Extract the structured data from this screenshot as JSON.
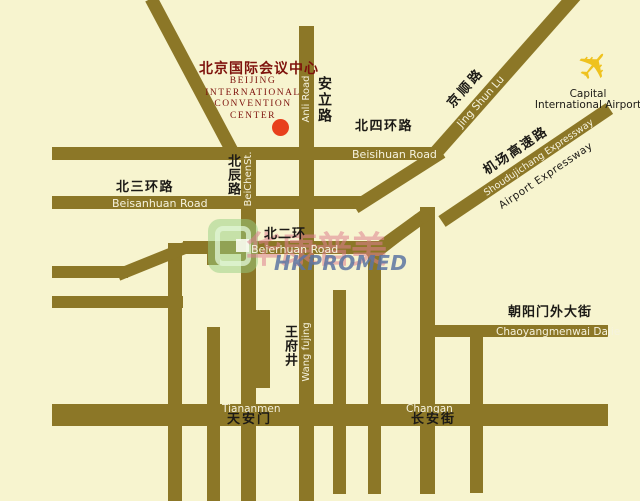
{
  "map": {
    "background_color": "#F7F4CF",
    "road_color": "#8C7727",
    "title": {
      "cn": "北京国际会议中心",
      "en_lines": [
        "BEIJING",
        "INTERNATIONAL",
        "CONVENTION",
        "CENTER"
      ],
      "color": "#7E120C"
    },
    "marker": {
      "color": "#E8401C"
    },
    "airport": {
      "line1": "Capital",
      "line2": "International Airport",
      "plane_color": "#EFC21F",
      "plane_glyph": "✈"
    },
    "roads": {
      "beisihuan": {
        "cn": "北四环路",
        "en": "Beisihuan Road"
      },
      "beisanhuan": {
        "cn": "北三环路",
        "en": "Beisanhuan Road"
      },
      "beierhuan": {
        "cn": "北二环",
        "en": "Beierhuan Road"
      },
      "beichen": {
        "cn": "北辰路",
        "en": "BeiChenSt."
      },
      "anli": {
        "cn": "安立路",
        "en": "Anli Road"
      },
      "jingshun": {
        "cn": "京顺路",
        "en": "Jing Shun Lu"
      },
      "airport_expressway": {
        "cn": "机场高速路",
        "en_on_road": "Shoudujichang Expressway",
        "en_below": "Airport Expressway"
      },
      "chaoyangmenwai": {
        "cn": "朝阳门外大街",
        "en": "Chaoyangmenwai Dajie"
      },
      "wangfujing": {
        "cn": "王府井",
        "en": "Wang fujing"
      },
      "tiananmen": {
        "cn": "天安门",
        "en": "Tiananmen"
      },
      "changan": {
        "cn": "长安街",
        "en": "Changan"
      }
    },
    "watermark": {
      "cn": "华康普美",
      "en": "HKPROMED",
      "en_color": "#5C74A2",
      "cn_color": "#DE8090",
      "logo_color": "#96CD82"
    }
  }
}
